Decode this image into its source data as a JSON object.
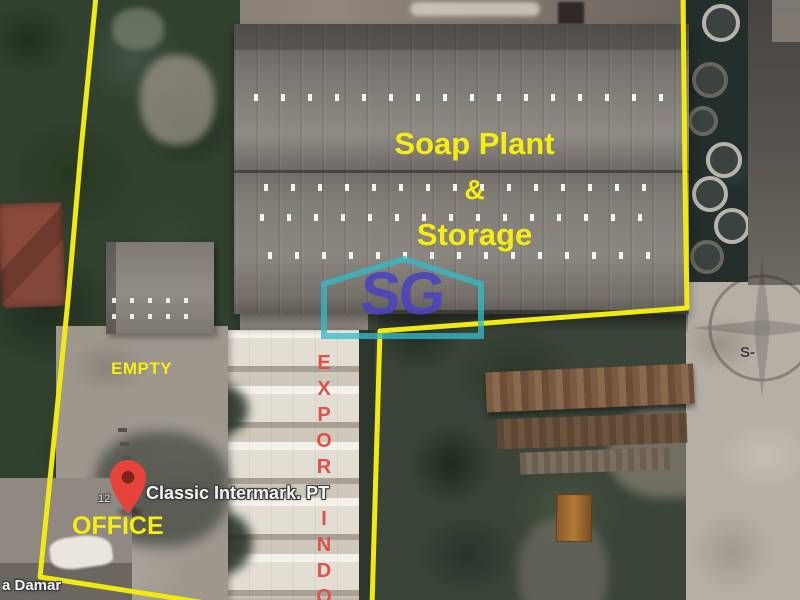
{
  "colors": {
    "boundary_yellow": "#f0ea12",
    "label_yellow": "#f7ee10",
    "exportindo_red": "#e05047",
    "pin_red": "#e6443a",
    "pin_dot": "#7e231c",
    "logo_indigo": "#4b44bd",
    "house_cyan": "#35b8c6"
  },
  "labels": {
    "building_line1": "Soap Plant",
    "building_line2": "&",
    "building_line3": "Storage",
    "empty": "EMPTY",
    "office": "OFFICE",
    "exportindo": "EXPORTINDO",
    "marker_name": "Classic Intermark. PT",
    "house_number": "12",
    "street_partial": "a Damar",
    "compass_south": "S-"
  },
  "watermark": {
    "logo_text": "SG"
  }
}
